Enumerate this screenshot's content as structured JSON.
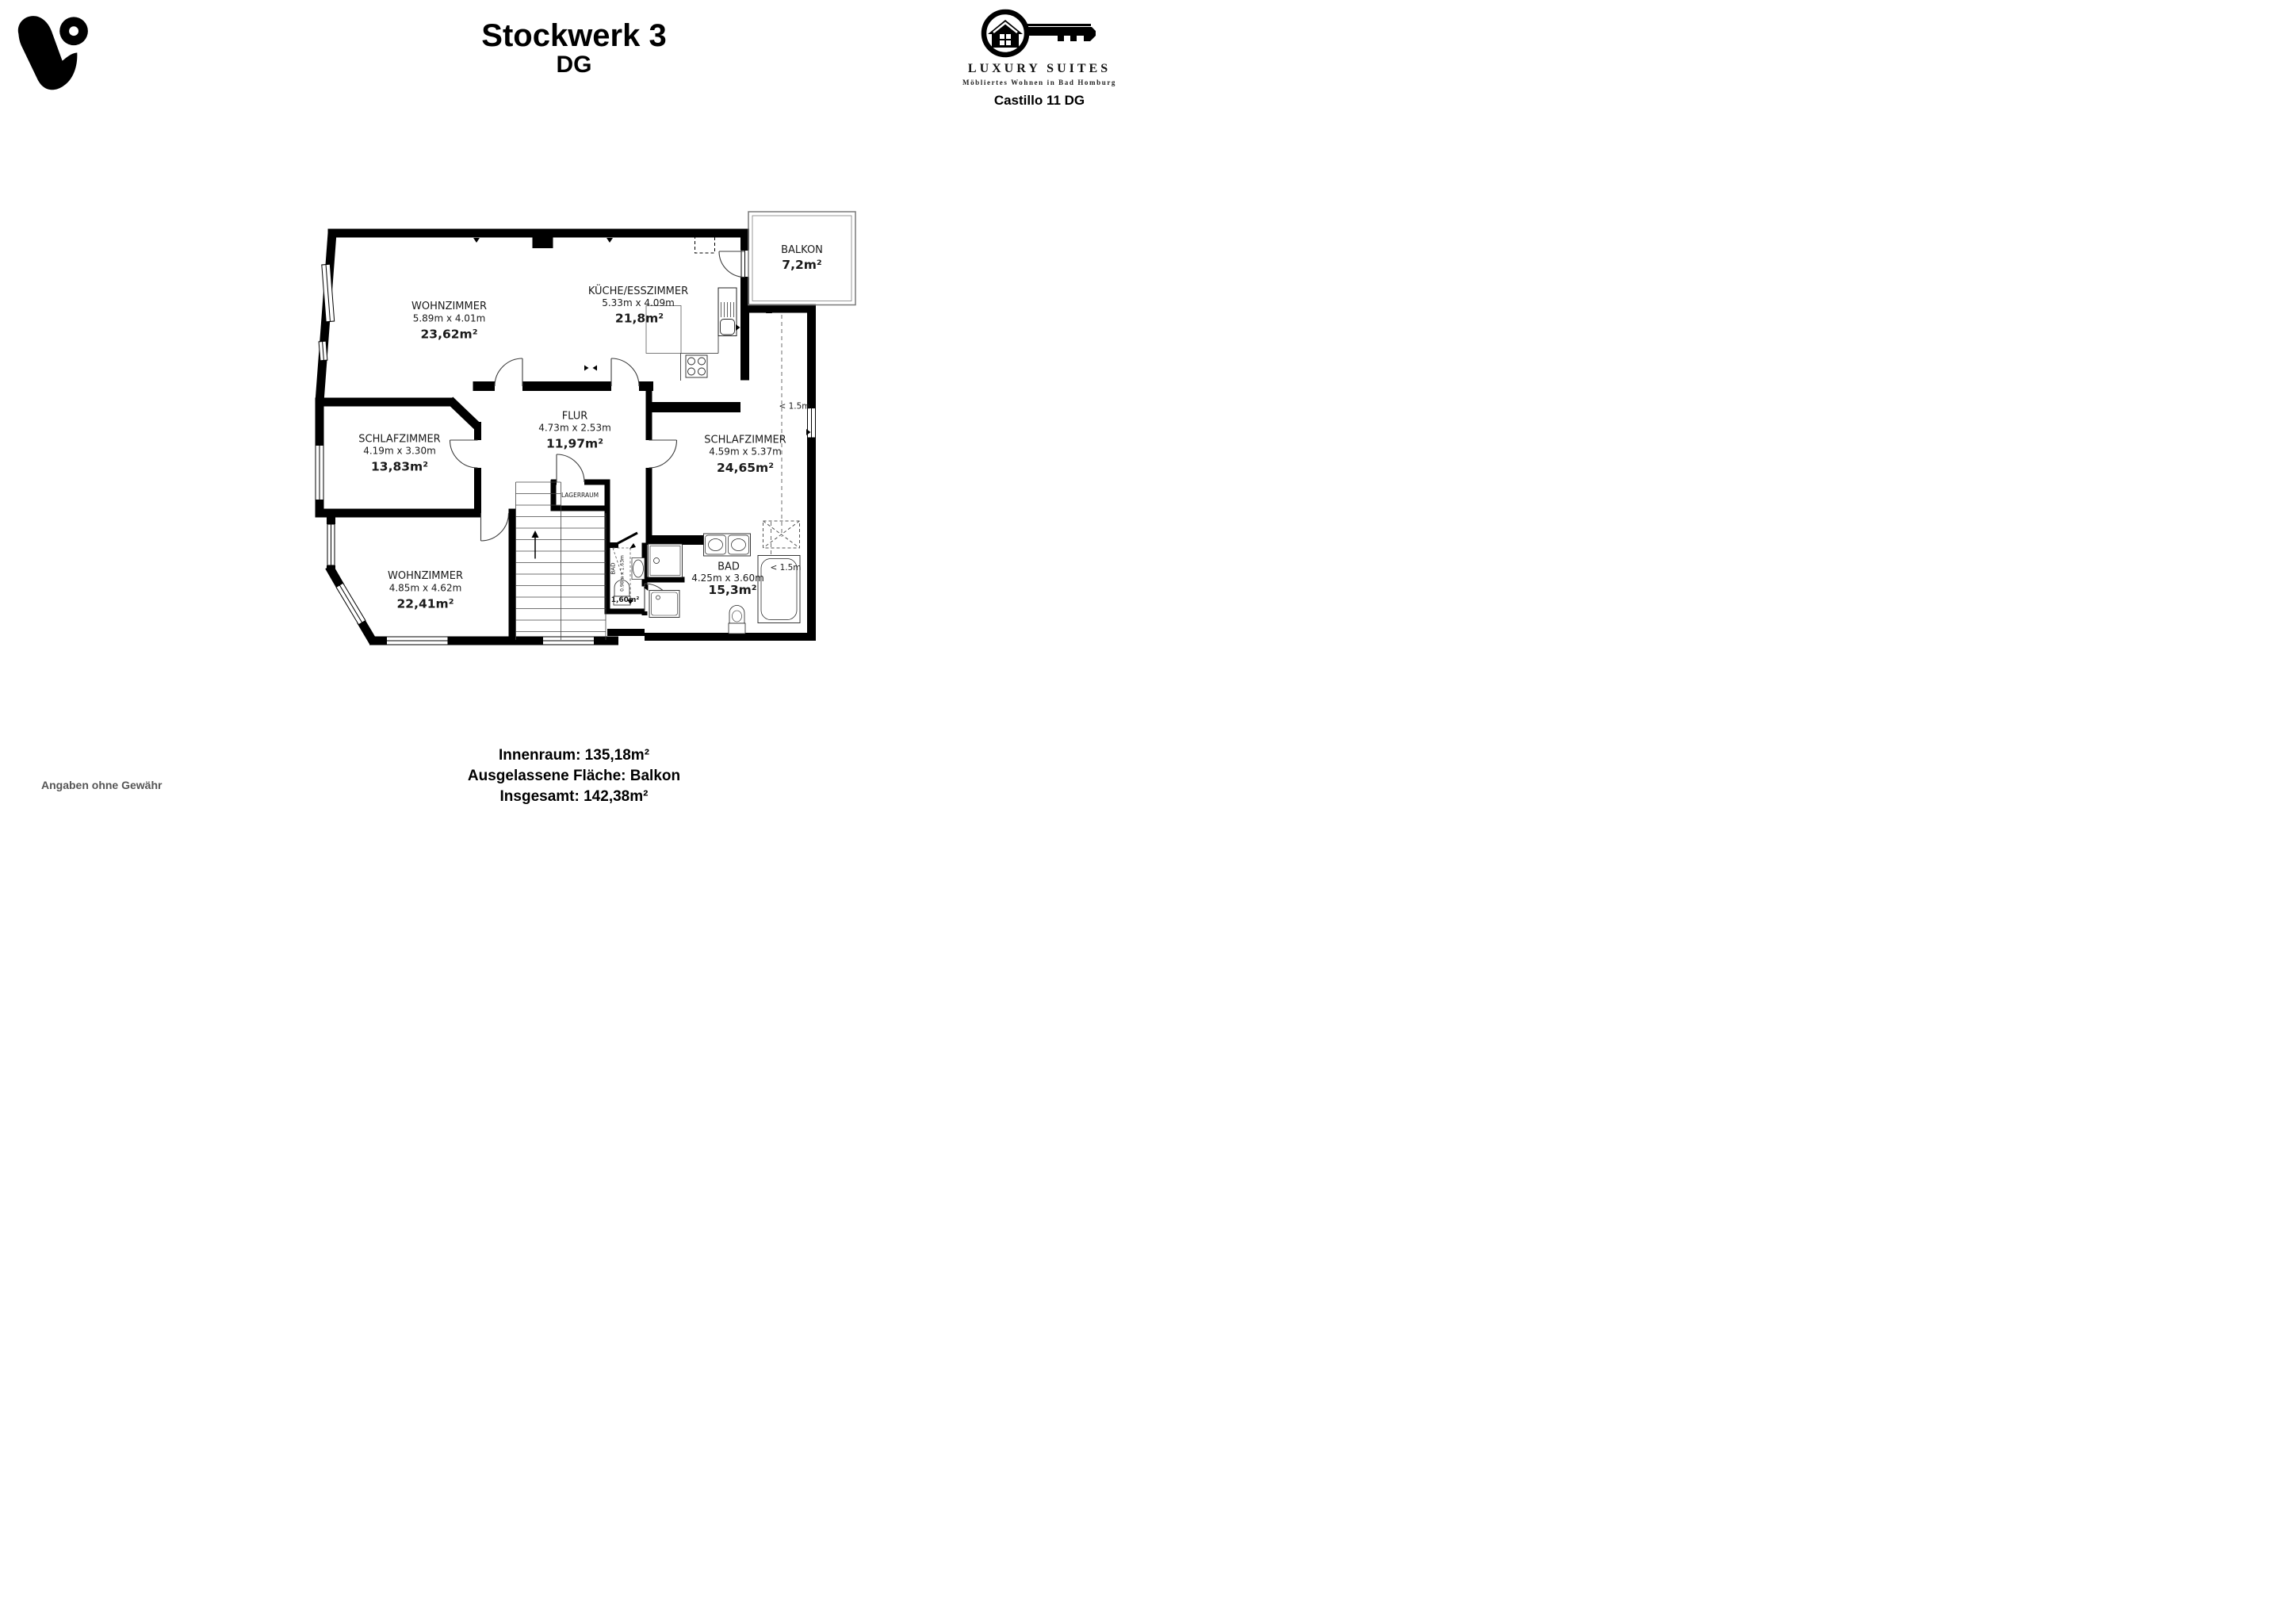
{
  "page": {
    "title": "Stockwerk 3",
    "subtitle": "DG"
  },
  "brand": {
    "name": "LUXURY SUITES",
    "tagline": "Möbliertes Wohnen in Bad Homburg",
    "property": "Castillo 11 DG"
  },
  "summary": {
    "line1": "Innenraum: 135,18m²",
    "line2": "Ausgelassene Fläche: Balkon",
    "line3": "Insgesamt: 142,38m²",
    "disclaimer": "Angaben ohne Gewähr"
  },
  "rooms": {
    "wohnzimmer_top": {
      "name": "WOHNZIMMER",
      "dims": "5.89m x 4.01m",
      "area": "23,62m²"
    },
    "kueche": {
      "name": "KÜCHE/ESSZIMMER",
      "dims": "5.33m x 4.09m",
      "area": "21,8m²"
    },
    "balkon": {
      "name": "BALKON",
      "area": "7,2m²"
    },
    "schlafzimmer_links": {
      "name": "SCHLAFZIMMER",
      "dims": "4.19m x 3.30m",
      "area": "13,83m²"
    },
    "flur": {
      "name": "FLUR",
      "dims": "4.73m x 2.53m",
      "area": "11,97m²"
    },
    "schlafzimmer_rechts": {
      "name": "SCHLAFZIMMER",
      "dims": "4.59m x 5.37m",
      "area": "24,65m²"
    },
    "wohnzimmer_unten": {
      "name": "WOHNZIMMER",
      "dims": "4.85m x 4.62m",
      "area": "22,41m²"
    },
    "bad": {
      "name": "BAD",
      "dims": "4.25m x 3.60m",
      "area": "15,3m²"
    },
    "bad_klein": {
      "name": "BAD",
      "dims": "0.98m x 1.63m",
      "area": "1,60m²"
    },
    "lagerraum": {
      "name": "LAGERRAUM"
    }
  },
  "annotations": {
    "height_note": "< 1.5m"
  },
  "colors": {
    "wall": "#000000",
    "disclaimer_gray": "#555555"
  }
}
